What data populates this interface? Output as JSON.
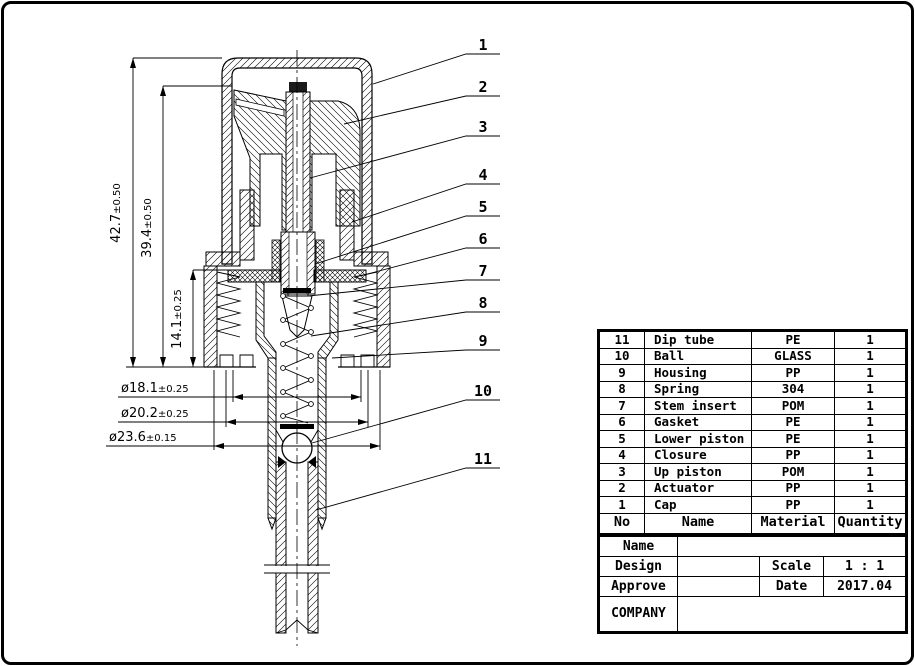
{
  "drawing": {
    "callouts": [
      {
        "n": "1"
      },
      {
        "n": "2"
      },
      {
        "n": "3"
      },
      {
        "n": "4"
      },
      {
        "n": "5"
      },
      {
        "n": "6"
      },
      {
        "n": "7"
      },
      {
        "n": "8"
      },
      {
        "n": "9"
      },
      {
        "n": "10"
      },
      {
        "n": "11"
      }
    ],
    "dims": [
      {
        "value": "42.7",
        "tol": "±0.50"
      },
      {
        "value": "39.4",
        "tol": "±0.50"
      },
      {
        "value": "14.1",
        "tol": "±0.25"
      }
    ],
    "diameters": [
      {
        "value": "ø18.1",
        "tol": "±0.25"
      },
      {
        "value": "ø20.2",
        "tol": "±0.25"
      },
      {
        "value": "ø23.6",
        "tol": "±0.15"
      }
    ]
  },
  "table": {
    "header": {
      "no": "No",
      "name": "Name",
      "material": "Material",
      "quantity": "Quantity"
    },
    "rows": [
      {
        "no": "11",
        "name": "Dip tube",
        "material": "PE",
        "qty": "1"
      },
      {
        "no": "10",
        "name": "Ball",
        "material": "GLASS",
        "qty": "1"
      },
      {
        "no": "9",
        "name": "Housing",
        "material": "PP",
        "qty": "1"
      },
      {
        "no": "8",
        "name": "Spring",
        "material": "304",
        "qty": "1"
      },
      {
        "no": "7",
        "name": "Stem insert",
        "material": "POM",
        "qty": "1"
      },
      {
        "no": "6",
        "name": "Gasket",
        "material": "PE",
        "qty": "1"
      },
      {
        "no": "5",
        "name": "Lower piston",
        "material": "PE",
        "qty": "1"
      },
      {
        "no": "4",
        "name": "Closure",
        "material": "PP",
        "qty": "1"
      },
      {
        "no": "3",
        "name": "Up piston",
        "material": "POM",
        "qty": "1"
      },
      {
        "no": "2",
        "name": "Actuator",
        "material": "PP",
        "qty": "1"
      },
      {
        "no": "1",
        "name": "Cap",
        "material": "PP",
        "qty": "1"
      }
    ],
    "title_block": {
      "name_label": "Name",
      "design_label": "Design",
      "approve_label": "Approve",
      "company_label": "COMPANY",
      "scale_label": "Scale",
      "scale_value": "1 : 1",
      "date_label": "Date",
      "date_value": "2017.04"
    }
  },
  "colors": {
    "ink": "#000000",
    "paper": "#ffffff"
  }
}
